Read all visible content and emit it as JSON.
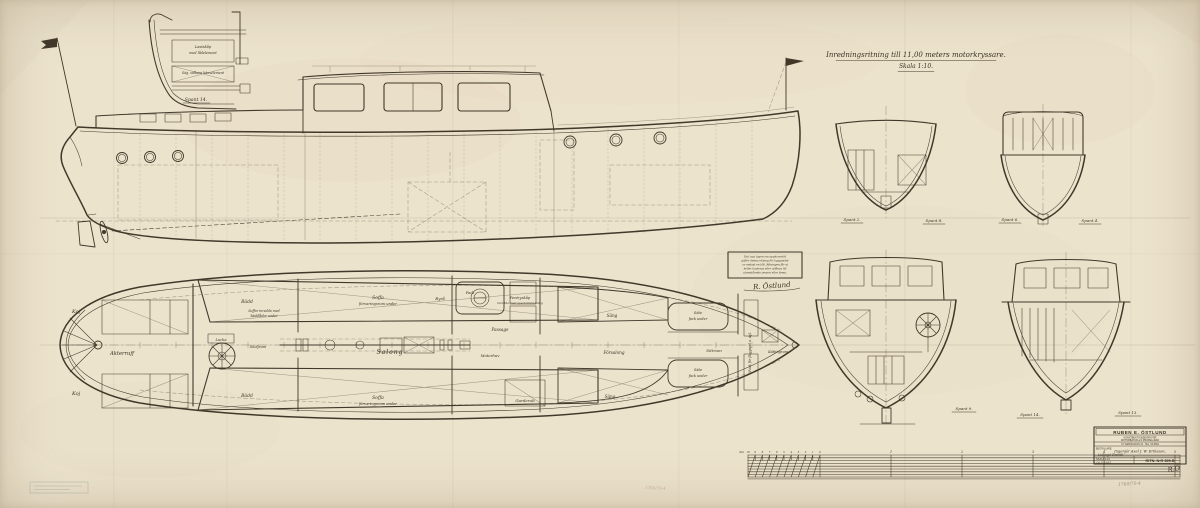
{
  "paper_color": "#ece3cd",
  "ink_color": "#42382a",
  "heading": {
    "title": "Inredningsritning till 11,00 meters motorkryssare.",
    "scale": "Skala 1:10."
  },
  "detail_view": {
    "note_line1": "Lastskåp",
    "note_line2": "med lådelement",
    "note_line3": "Säg. sidbara bänselement",
    "caption": "Spant 14."
  },
  "plan_labels": {
    "koj_top": "Koj",
    "koj_bottom": "Koj",
    "akterruff": "Akterruff",
    "lucka": "Lucka",
    "skoljrum": "Sköljrum",
    "badd_top": "Bädd",
    "badd_bottom": "Bädd",
    "soffa_note1": "Soffor inredda med",
    "soffa_note2": "bäddlådor under",
    "soffa_top1": "Soffa",
    "soffa_top2": "förvaringsrum under",
    "soffa_bottom1": "Soffa",
    "soffa_bottom2": "förvaringsrum under",
    "salong": "Salong",
    "byra": "Byrå",
    "fack": "Fack",
    "pentryskap1": "Pentryskåp",
    "pentryskap2": "inredda med specialinredning",
    "passage": "Passage",
    "motorhuv": "Motorhuv",
    "garderob": "Garderob",
    "forsalong": "Försalong",
    "sang_top": "Säng",
    "sang_bottom": "Säng",
    "sate_top1": "Säte",
    "sate_top2": "fack under",
    "sate_bottom1": "Säte",
    "sate_bottom2": "fack under",
    "sittrum": "Sittrum",
    "kattingrum": "Kättingrum",
    "fack_flagg": "Fack för flaggspel o. dyl."
  },
  "section_labels": {
    "s2": "Spant 2.",
    "s8": "Spant 8.",
    "s6": "Spant 6.",
    "s4": "Spant 4.",
    "s9": "Spant 9.",
    "s14": "Spant 14.",
    "s13": "Spant 13."
  },
  "note_box": {
    "lines": [
      "Enl. nya lagen om upphovsrätt",
      "gäller denna ritning för byggandet",
      "av endast en båt. Ritningen får ej",
      "heller kopieras eller utlånas till",
      "utomstående person eller firma."
    ],
    "signature": "R. Östlund"
  },
  "title_block": {
    "company": "RUBEN E. ÖSTLUND",
    "byline1": "KONSTRUKTIONSBYRÅ FÖR",
    "byline2": "MOTORBÅTAR och PROPELLRAR",
    "address": "S:T ERIKSGATAN 31  ·  TEL. VA 6691",
    "orderer_label": "BESTÄLLARE:",
    "orderer_line1": "Ingenjör Axel J. W. Eriksson,",
    "orderer_line2": "Lidingö-Brevik",
    "scale_cell": "SKALA 1:10",
    "date_cell": "14.5.1932",
    "drawing_no": "RITN. N:R 305.B",
    "initials": "R.Ö"
  },
  "scale_bar": {
    "unit_label": "dm",
    "dm_numbers": [
      "10",
      "9",
      "8",
      "7",
      "6",
      "5",
      "4",
      "3",
      "2",
      "1",
      "0"
    ],
    "meter_numbers": [
      "1",
      "2",
      "3",
      "4",
      "5"
    ]
  },
  "pencil_note": "1760/70-4"
}
